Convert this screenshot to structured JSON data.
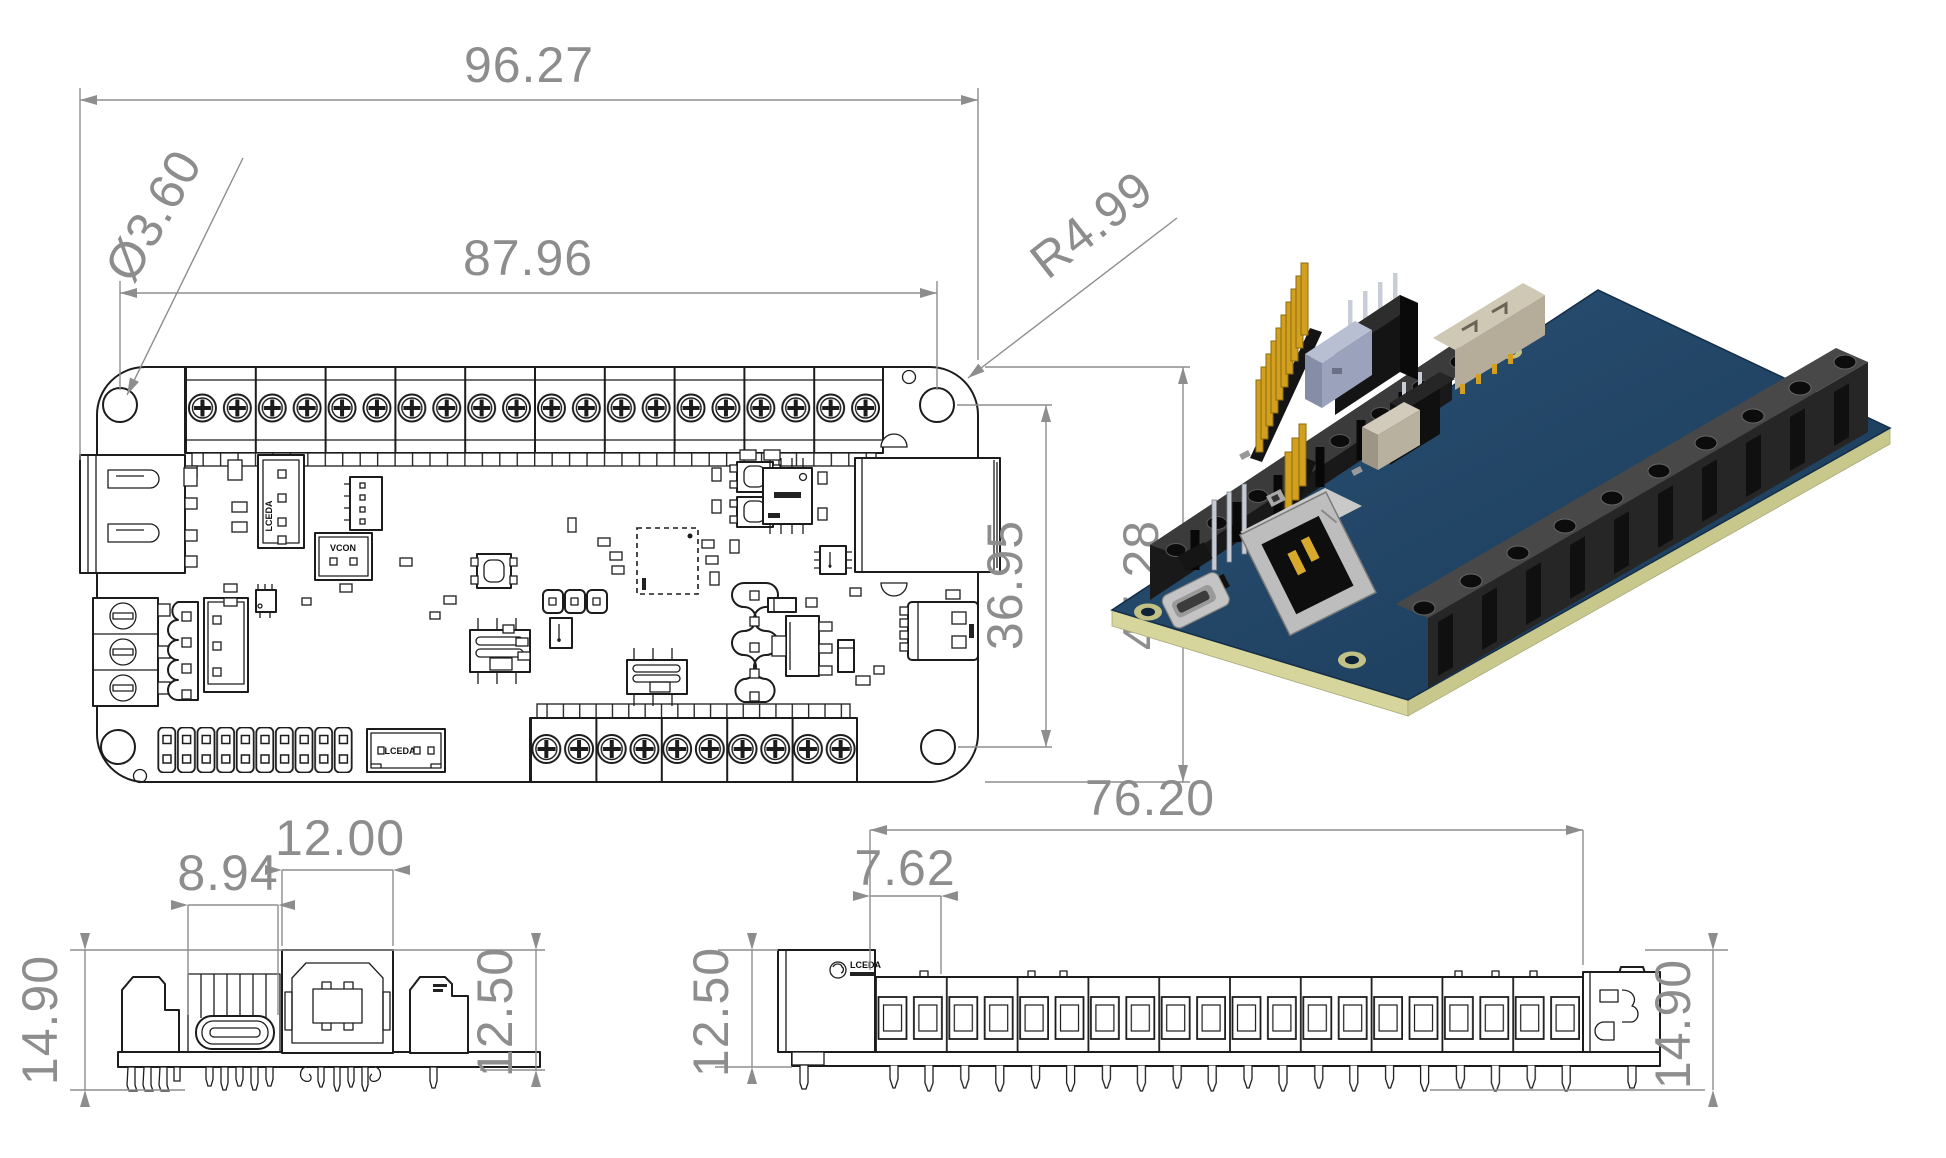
{
  "drawing": {
    "top_view": {
      "total_width": "96.27",
      "hole_pitch": "87.96",
      "hole_diameter": "Ø3.60",
      "corner_radius": "R4.99",
      "hole_offset_vertical": "36.95",
      "board_height": "45.28",
      "connector_label_1": "LCEDA",
      "connector_label_2": "VCON",
      "connector_label_3": "LCEDA"
    },
    "front_view": {
      "usb_c_width": "8.94",
      "usb_b_width": "12.00",
      "overall_height": "14.90",
      "connector_height": "12.50"
    },
    "side_view": {
      "terminal_row_length": "76.20",
      "terminal_pitch": "7.62",
      "connector_height": "12.50",
      "overall_height": "14.90",
      "logo_text": "LCEDA"
    }
  },
  "colors": {
    "line": "#1c1c1c",
    "dimension": "#8d8d8d",
    "pcb_top": "#20446a",
    "pcb_edge": "#d6d69c",
    "pin_gold": "#d2a01e",
    "connector_dark": "#1a1a1a",
    "usb_metal": "#c0c0c0"
  }
}
